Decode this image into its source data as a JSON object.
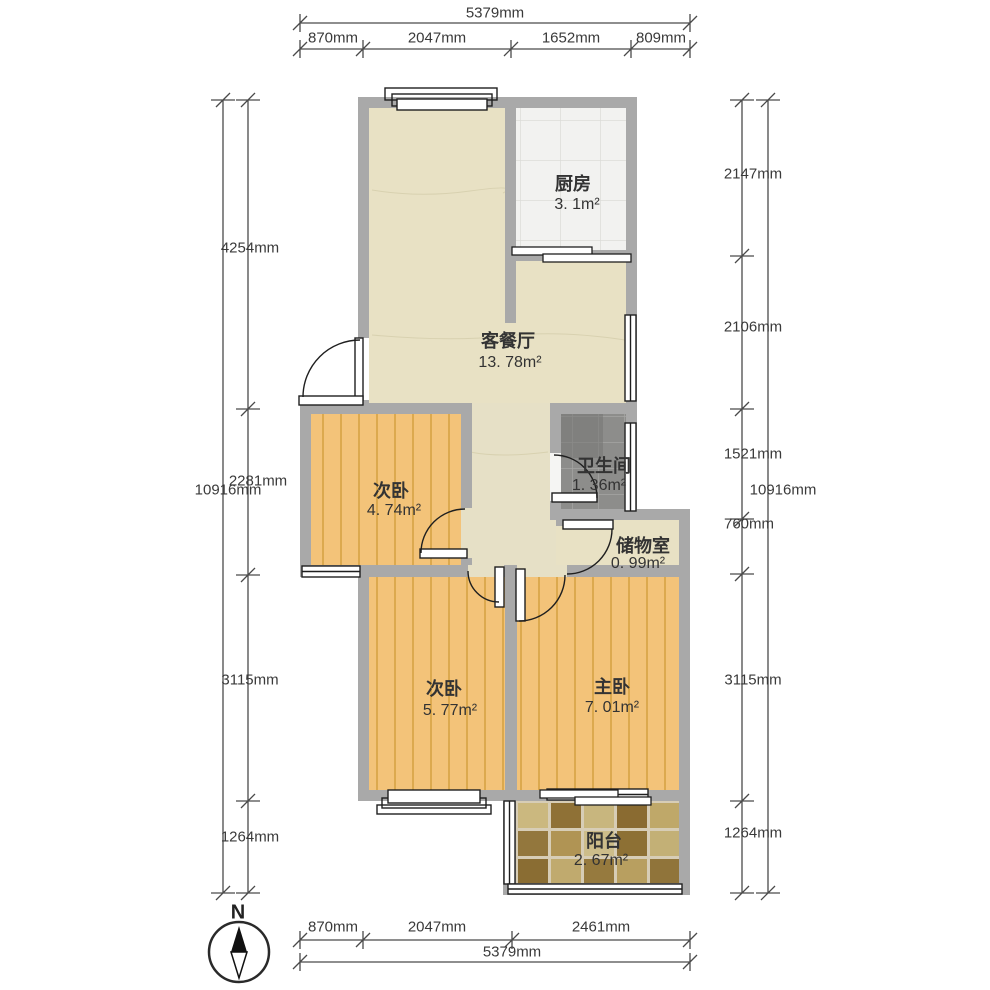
{
  "compass": {
    "label": "N"
  },
  "rooms": {
    "kitchen": {
      "name": "厨房",
      "area": "3. 1m²"
    },
    "living": {
      "name": "客餐厅",
      "area": "13. 78m²"
    },
    "bathroom": {
      "name": "卫生间",
      "area": "1. 36m²"
    },
    "storage": {
      "name": "储物室",
      "area": "0. 99m²"
    },
    "bedroom2a": {
      "name": "次卧",
      "area": "4. 74m²"
    },
    "bedroom2b": {
      "name": "次卧",
      "area": "5. 77m²"
    },
    "master": {
      "name": "主卧",
      "area": "7. 01m²"
    },
    "balcony": {
      "name": "阳台",
      "area": "2. 67m²"
    }
  },
  "dimensions": {
    "top": {
      "total": "5379mm",
      "segments": [
        "870mm",
        "2047mm",
        "1652mm",
        "809mm"
      ]
    },
    "bottom": {
      "total": "5379mm",
      "segments": [
        "870mm",
        "2047mm",
        "2461mm"
      ]
    },
    "left": {
      "total": "10916mm",
      "segments": [
        "4254mm",
        "2281mm",
        "3115mm",
        "1264mm"
      ]
    },
    "right": {
      "total": "10916mm",
      "segments": [
        "2147mm",
        "2106mm",
        "1521mm",
        "760mm",
        "3115mm",
        "1264mm"
      ]
    }
  },
  "palette": {
    "wall": "#a9a9a9",
    "living_floor": "#e8e1c4",
    "wood_floor": "#f3c379",
    "wood_line": "#dca94e",
    "kitchen_floor": "#f2f2f0",
    "bath_floor": "#8d8d8b",
    "balcony_tiles": [
      "#cbb87f",
      "#8f7136",
      "#c8b67e",
      "#8a6b31",
      "#bfa869",
      "#93773d",
      "#b09454",
      "#cdbd8a",
      "#8d7034",
      "#c3b076",
      "#8a6d33",
      "#c0aa6e",
      "#967a3e",
      "#b89f60",
      "#90743a"
    ],
    "dimension_line": "#4a4a4a"
  }
}
